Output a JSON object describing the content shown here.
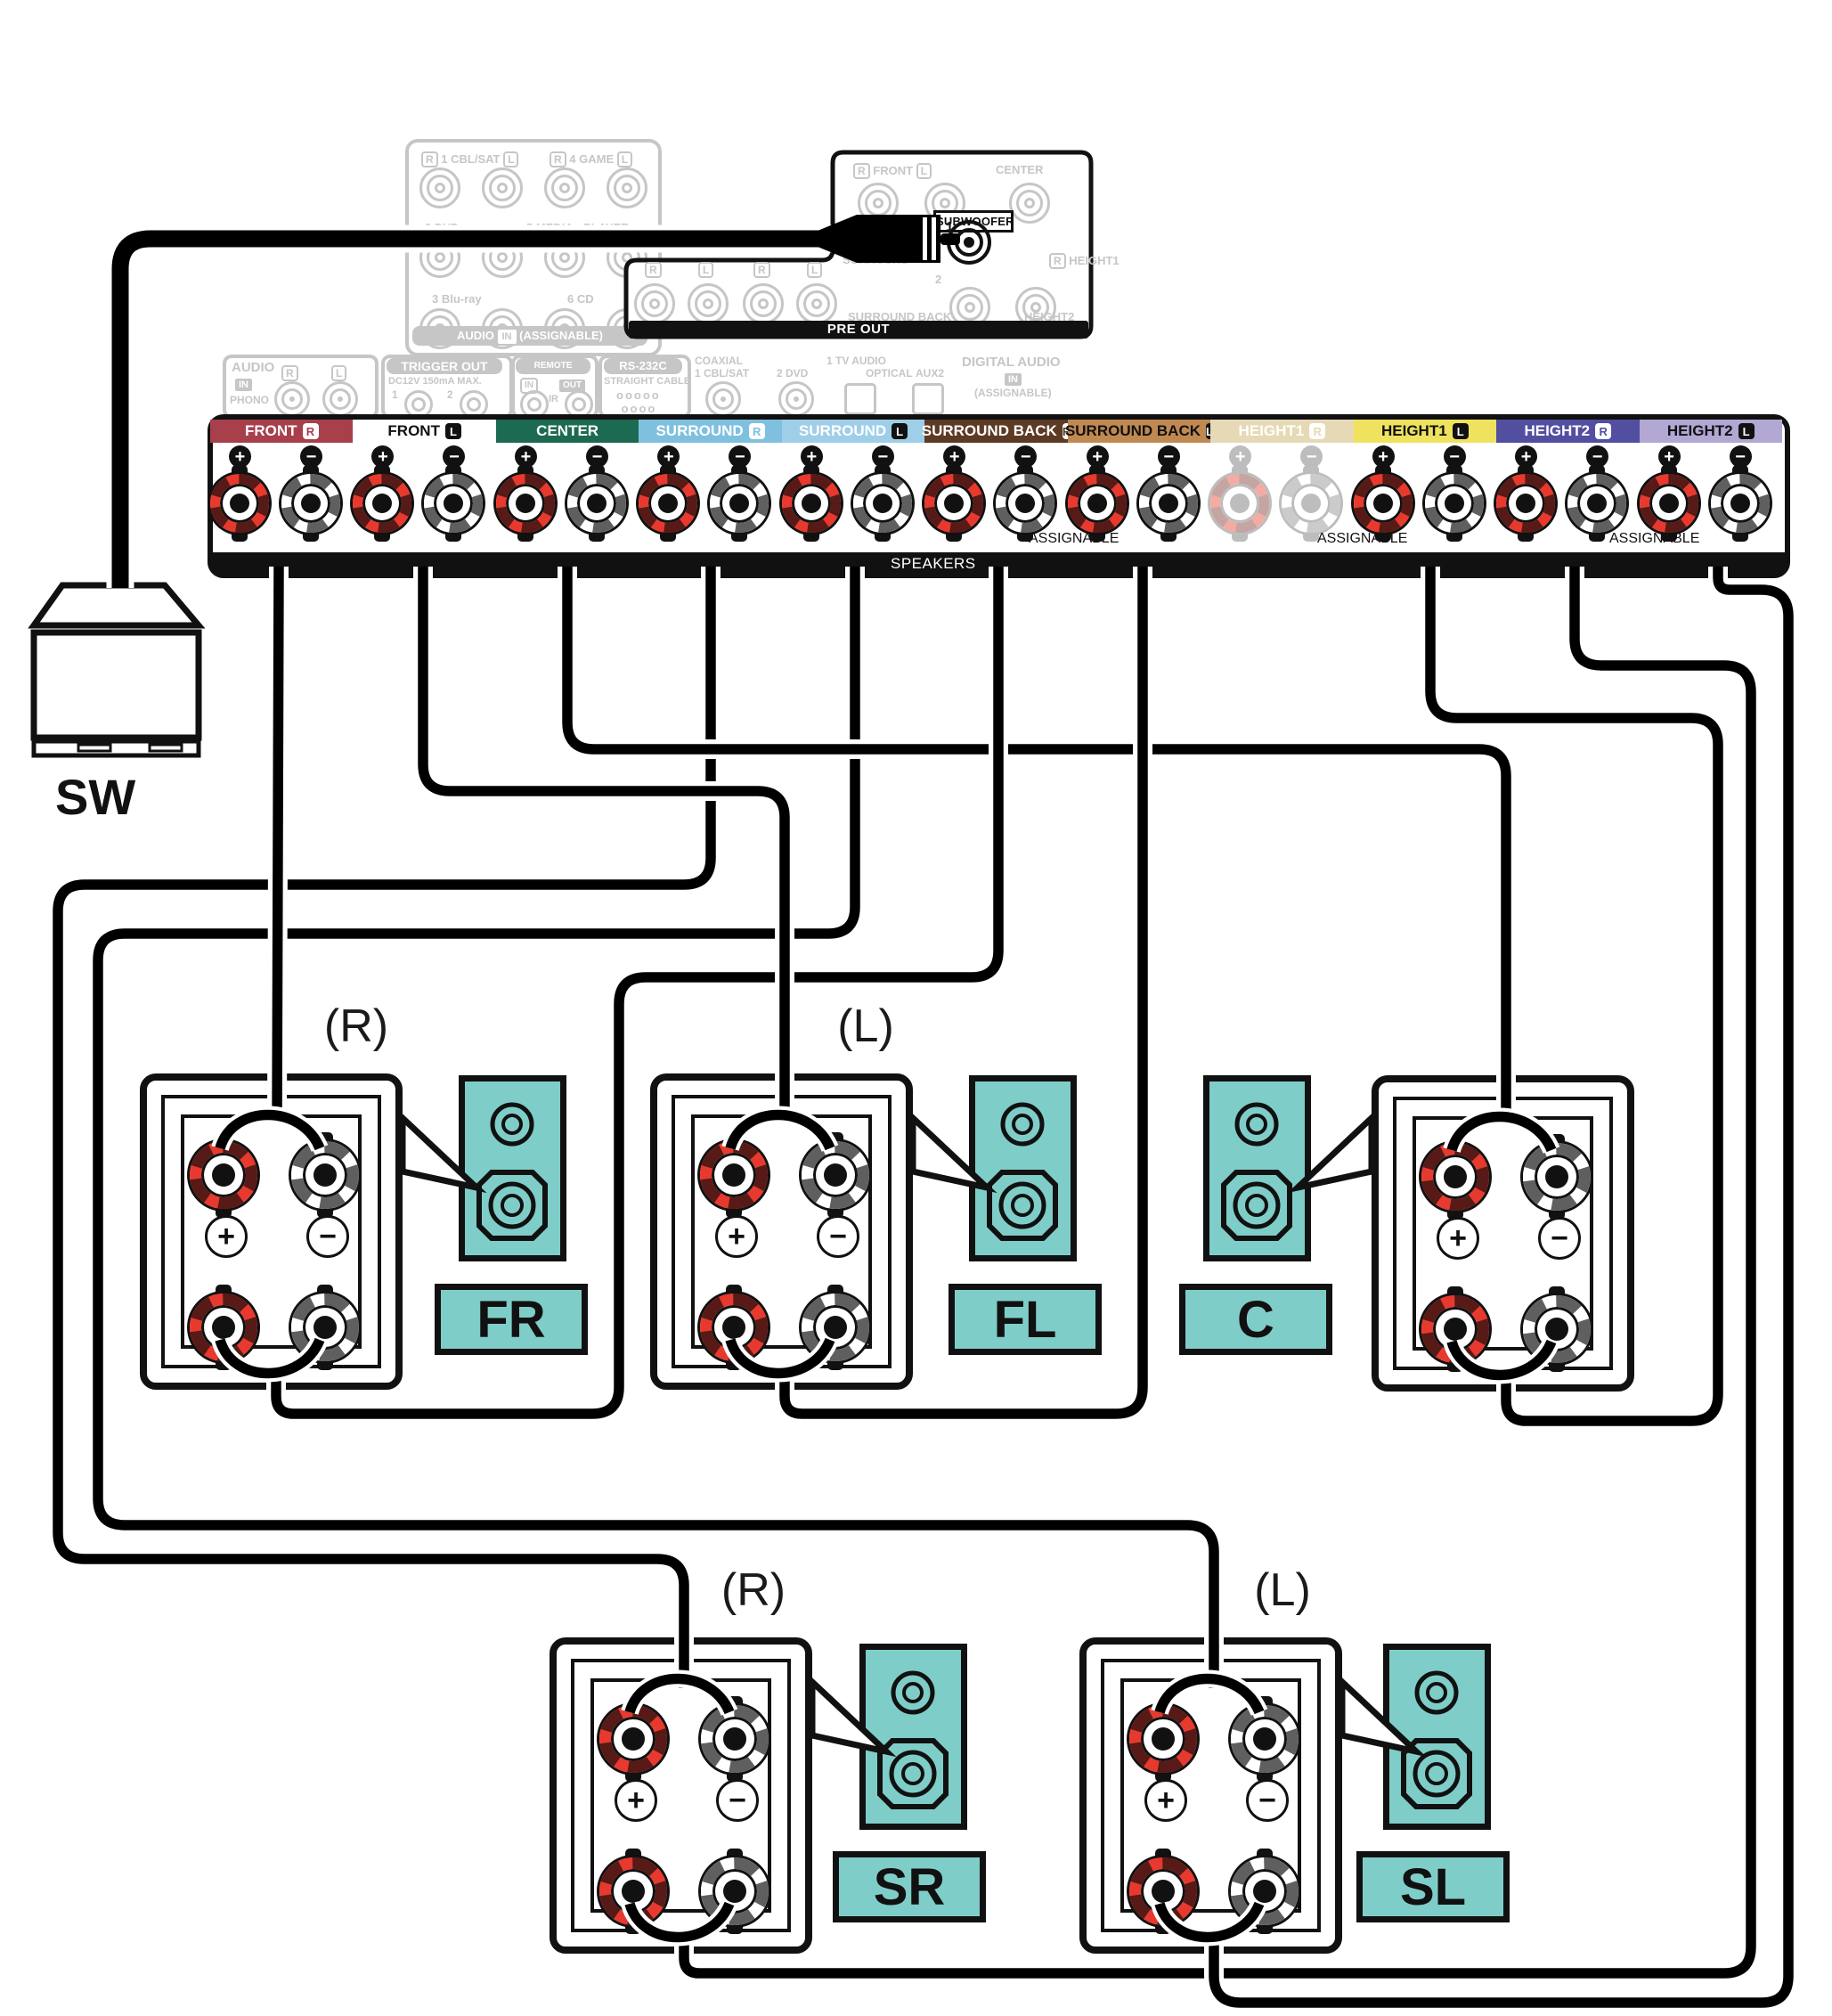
{
  "diagram_title": "5.1-channel bi-amp speaker connection",
  "symbols": {
    "plus": "+",
    "minus": "−"
  },
  "colors": {
    "teal": "#7fcdc8",
    "cable": "#000000",
    "active_red": "#e8392e",
    "faded": "#c6c6c6",
    "outline": "#111111"
  },
  "rear_top_panel": {
    "row1_left_badge": "R",
    "row1_left": "1 CBL/SAT",
    "row1_left_badge2": "L",
    "row1_right_badge": "R",
    "row1_right": "4 GAME",
    "row1_right_badge2": "L",
    "row2_left": "2 DVD",
    "row2_right_a": "5 MEDIA",
    "row2_right_b": "PLAYER",
    "row3_left": "3 Blu-ray",
    "row3_right": "6 CD",
    "bottom_bar_a": "AUDIO",
    "bottom_bar_chip": "IN",
    "bottom_bar_b": "(ASSIGNABLE)"
  },
  "pre_out": {
    "bar_label": "PRE OUT",
    "front_badge_r": "R",
    "front": "FRONT",
    "front_badge_l": "L",
    "center": "CENTER",
    "surround": "SURROUND",
    "subwoofer": "SUBWOOFER",
    "sub_jack1": "1",
    "sub_jack2": "2",
    "height1_badge": "R",
    "height1": "HEIGHT1",
    "rl_row": [
      "R",
      "L",
      "R",
      "L"
    ],
    "surround_back": "SURROUND BACK",
    "height2": "HEIGHT2"
  },
  "small_panels": {
    "phono": {
      "title": "AUDIO",
      "chip": "IN",
      "r": "R",
      "l": "L",
      "name": "PHONO"
    },
    "trigger": {
      "title": "TRIGGER OUT",
      "sub": "DC12V 150mA MAX.",
      "n1": "1",
      "n2": "2"
    },
    "remote": {
      "title": "REMOTE CONTROL",
      "chip_in": "IN",
      "chip_out": "OUT",
      "ir": "IR"
    },
    "rs232c": {
      "title": "RS-232C",
      "sub": "STRAIGHT CABLE"
    },
    "digital": {
      "coaxial": "COAXIAL",
      "cbl": "1 CBL/SAT",
      "dvd": "2 DVD",
      "tv": "1 TV AUDIO",
      "optical": "OPTICAL",
      "aux": "AUX2",
      "title": "DIGITAL AUDIO",
      "chip": "IN",
      "assignable": "(ASSIGNABLE)"
    }
  },
  "terminal_strip": {
    "speakers_label": "SPEAKERS",
    "assignable_labels": [
      "ASSIGNABLE",
      "ASSIGNABLE",
      "ASSIGNABLE"
    ],
    "channels": [
      {
        "id": "front-r",
        "label": "FRONT",
        "badge": "R",
        "bg": "#a8404c",
        "fg": "#ffffff",
        "badge_dark": false,
        "faded": false
      },
      {
        "id": "front-l",
        "label": "FRONT",
        "badge": "L",
        "bg": "#ffffff",
        "fg": "#111111",
        "badge_dark": true,
        "faded": false
      },
      {
        "id": "center",
        "label": "CENTER",
        "badge": "",
        "bg": "#1d6a52",
        "fg": "#ffffff",
        "badge_dark": false,
        "faded": false
      },
      {
        "id": "surround-r",
        "label": "SURROUND",
        "badge": "R",
        "bg": "#7fc0df",
        "fg": "#ffffff",
        "badge_dark": false,
        "faded": false
      },
      {
        "id": "surround-l",
        "label": "SURROUND",
        "badge": "L",
        "bg": "#9fcee8",
        "fg": "#ffffff",
        "badge_dark": true,
        "faded": false
      },
      {
        "id": "surround-back-r",
        "label": "SURROUND BACK",
        "badge": "R",
        "bg": "#5c3a24",
        "fg": "#ffffff",
        "badge_dark": false,
        "faded": false
      },
      {
        "id": "surround-back-l",
        "label": "SURROUND BACK",
        "badge": "L",
        "bg": "#c08952",
        "fg": "#111111",
        "badge_dark": true,
        "faded": false
      },
      {
        "id": "height1-r",
        "label": "HEIGHT1",
        "badge": "R",
        "bg": "#e6d9b5",
        "fg": "#ffffff",
        "badge_dark": false,
        "faded": true
      },
      {
        "id": "height1-l",
        "label": "HEIGHT1",
        "badge": "L",
        "bg": "#efe25f",
        "fg": "#111111",
        "badge_dark": true,
        "faded": false
      },
      {
        "id": "height2-r",
        "label": "HEIGHT2",
        "badge": "R",
        "bg": "#524fa1",
        "fg": "#ffffff",
        "badge_dark": false,
        "faded": false
      },
      {
        "id": "height2-l",
        "label": "HEIGHT2",
        "badge": "L",
        "bg": "#b3a7d4",
        "fg": "#111111",
        "badge_dark": true,
        "faded": false
      }
    ]
  },
  "subwoofer_speaker": {
    "label": "SW"
  },
  "speakers": [
    {
      "id": "FR",
      "label": "FR",
      "position_label": "(R)"
    },
    {
      "id": "FL",
      "label": "FL",
      "position_label": "(L)"
    },
    {
      "id": "C",
      "label": "C",
      "position_label": ""
    },
    {
      "id": "SR",
      "label": "SR",
      "position_label": "(R)"
    },
    {
      "id": "SL",
      "label": "SL",
      "position_label": "(L)"
    }
  ],
  "connections": [
    {
      "id": "surround_r",
      "from": "SURROUND R terminal",
      "to": "SR speaker upper posts"
    },
    {
      "id": "surround_l",
      "from": "SURROUND L terminal",
      "to": "SL speaker upper posts"
    },
    {
      "id": "center",
      "from": "CENTER terminal",
      "to": "C speaker upper posts"
    },
    {
      "id": "surround_back_r",
      "from": "SURROUND BACK R terminal",
      "to": "FR speaker lower posts"
    },
    {
      "id": "front_l",
      "from": "FRONT L terminal",
      "to": "FL speaker upper posts"
    },
    {
      "id": "surround_back_l",
      "from": "SURROUND BACK L terminal",
      "to": "FL speaker lower posts"
    },
    {
      "id": "height1_l",
      "from": "HEIGHT1 L terminal",
      "to": "C speaker lower posts"
    },
    {
      "id": "height2_r",
      "from": "HEIGHT2 R terminal",
      "to": "SR speaker lower posts"
    },
    {
      "id": "height2_l",
      "from": "HEIGHT2 L terminal",
      "to": "SL speaker lower posts"
    },
    {
      "id": "front_r",
      "from": "FRONT R terminal",
      "to": "FR speaker upper posts"
    },
    {
      "id": "subwoofer",
      "from": "SUBWOOFER PRE OUT 1",
      "to": "SW subwoofer"
    }
  ]
}
